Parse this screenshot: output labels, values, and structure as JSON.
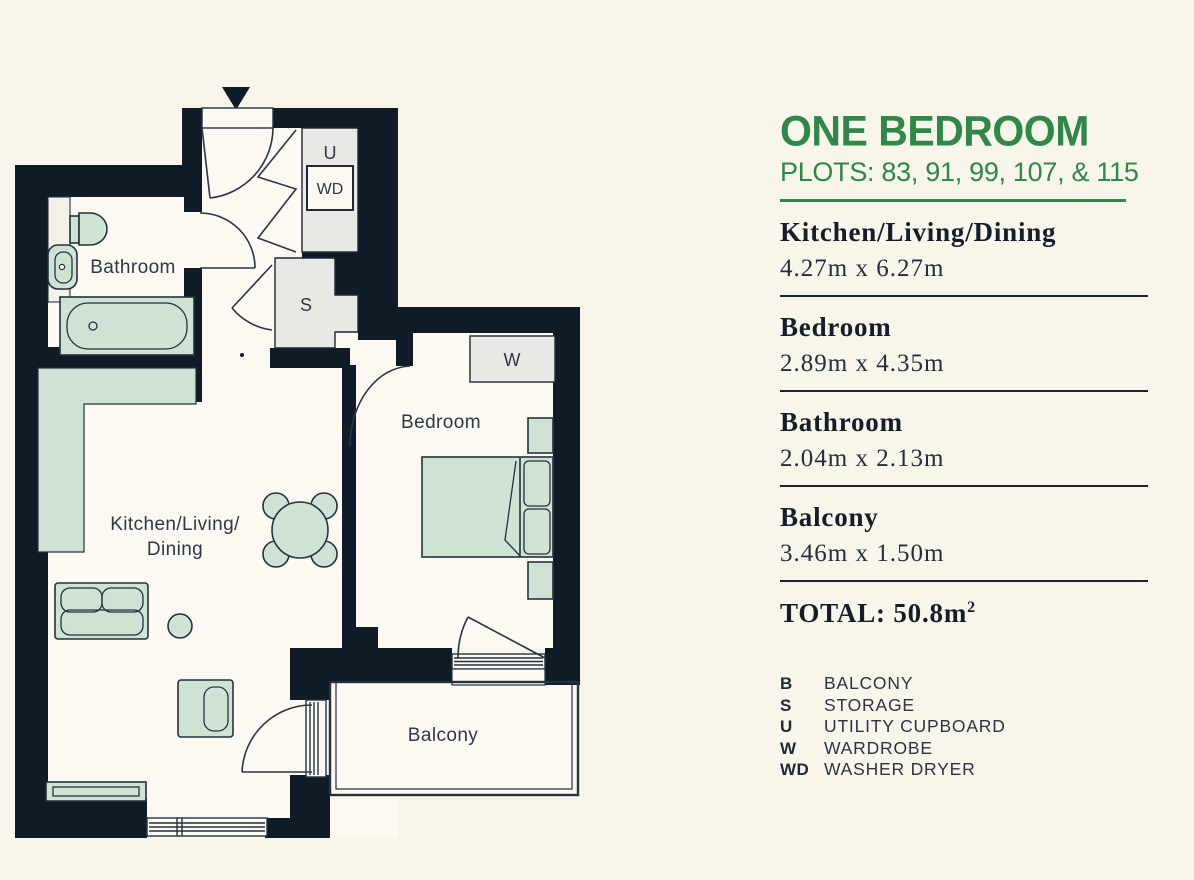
{
  "plan": {
    "labels": {
      "bathroom": "Bathroom",
      "kitchen_line1": "Kitchen/Living/",
      "kitchen_line2": "Dining",
      "bedroom": "Bedroom",
      "balcony": "Balcony",
      "utility": "U",
      "washer_dryer": "WD",
      "storage": "S",
      "wardrobe": "W"
    },
    "colors": {
      "wall": "#101b28",
      "floor": "#fbf9f1",
      "fixture_green": "#cfe3d4",
      "box_gray": "#e9e8e4",
      "line": "#24313f"
    }
  },
  "panel": {
    "title": "ONE BEDROOM",
    "plots": "PLOTS: 83, 91, 99, 107, & 115",
    "rooms": [
      {
        "name": "Kitchen/Living/Dining",
        "dims": "4.27m x 6.27m"
      },
      {
        "name": "Bedroom",
        "dims": "2.89m x 4.35m"
      },
      {
        "name": "Bathroom",
        "dims": "2.04m x 2.13m"
      },
      {
        "name": "Balcony",
        "dims": "3.46m x 1.50m"
      }
    ],
    "total_label": "TOTAL: 50.8m",
    "total_sup": "2",
    "legend": [
      {
        "key": "B",
        "value": "BALCONY"
      },
      {
        "key": "S",
        "value": "STORAGE"
      },
      {
        "key": "U",
        "value": "UTILITY CUPBOARD"
      },
      {
        "key": "W",
        "value": "WARDROBE"
      },
      {
        "key": "WD",
        "value": "WASHER DRYER"
      }
    ],
    "accent_green": "#2f8847",
    "ink": "#1a2330"
  }
}
